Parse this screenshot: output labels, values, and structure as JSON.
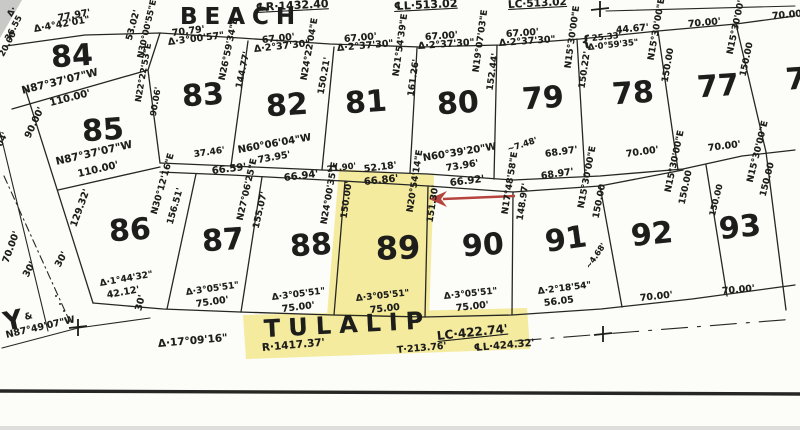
{
  "document": {
    "type": "scanned plat map",
    "streets": {
      "top": "BEACH",
      "bottom": "TULALIP",
      "left": "Y"
    },
    "highlighted_lot": "89",
    "lot_numbers_visible": [
      "77",
      "78",
      "79",
      "80",
      "81",
      "82",
      "83",
      "84",
      "85",
      "86",
      "87",
      "88",
      "89",
      "90",
      "91",
      "92",
      "93"
    ],
    "beach_curve_annotations": [
      "℄R·1432.40",
      "℄L·513.02",
      "LC·513.02"
    ],
    "tulalip_curve_annotations": [
      "Δ·17°09'16\"",
      "R·1417.37'",
      "T·213.76'",
      "℄L·424.32'",
      "LC·422.74'"
    ]
  },
  "colors": {
    "ink": "#262624",
    "highlight": "#f3e996",
    "arrow": "#b5443e",
    "paper": "#fcfcf8"
  },
  "labels": [
    {
      "t": "℄R·1432.40",
      "x": 256,
      "y": 2,
      "r": -3,
      "fs": 11,
      "u": 1
    },
    {
      "t": "℄L·513.02",
      "x": 394,
      "y": 1,
      "r": -3,
      "fs": 11,
      "u": 1
    },
    {
      "t": "LC·513.02",
      "x": 508,
      "y": 0,
      "r": -3,
      "fs": 10.5,
      "u": 1
    },
    {
      "t": "BEACH",
      "x": 180,
      "y": 6,
      "fs": 23,
      "w": 700,
      "ls": 7,
      "n": "street-name-beach"
    },
    {
      "t": "77.97'",
      "x": 58,
      "y": 14,
      "r": -10
    },
    {
      "t": "Δ·4°42'01\"",
      "x": 34,
      "y": 25,
      "r": -10
    },
    {
      "t": "70.79'",
      "x": 172,
      "y": 29,
      "r": -7
    },
    {
      "t": "Δ·3°00'57\"",
      "x": 168,
      "y": 38,
      "r": -7
    },
    {
      "t": "67.00'",
      "x": 262,
      "y": 36,
      "r": -6
    },
    {
      "t": "Δ·2°37'30\"",
      "x": 254,
      "y": 45,
      "r": -6
    },
    {
      "t": "67.00'",
      "x": 344,
      "y": 35,
      "r": -5
    },
    {
      "t": "Δ·2°37'30\"",
      "x": 337,
      "y": 44,
      "r": -5
    },
    {
      "t": "67.00'",
      "x": 425,
      "y": 33,
      "r": -4
    },
    {
      "t": "Δ·2°37'30\"",
      "x": 418,
      "y": 42,
      "r": -4
    },
    {
      "t": "67.00'",
      "x": 506,
      "y": 30,
      "r": -4
    },
    {
      "t": "Δ·2°37'30\"",
      "x": 499,
      "y": 39,
      "r": -4
    },
    {
      "t": "44.67'",
      "x": 616,
      "y": 26,
      "r": -5
    },
    {
      "t": "{",
      "x": 581,
      "y": 35,
      "r": -8,
      "fs": 15
    },
    {
      "t": "25.33'",
      "x": 592,
      "y": 35,
      "r": -6,
      "fs": 8.5
    },
    {
      "t": "Δ·0°59'35\"",
      "x": 588,
      "y": 44,
      "r": -6,
      "fs": 8.5
    },
    {
      "t": "70.00'",
      "x": 688,
      "y": 20,
      "r": -5
    },
    {
      "t": "70.00'",
      "x": 772,
      "y": 12,
      "r": -5
    },
    {
      "t": "Δ·",
      "x": 10,
      "y": 12,
      "r": -60,
      "fs": 8.5
    },
    {
      "t": "36.55",
      "x": 8,
      "y": 36,
      "r": -62,
      "fs": 8.5
    },
    {
      "t": "20.00",
      "x": 2,
      "y": 52,
      "r": -62,
      "fs": 8.5
    },
    {
      "t": "04'",
      "x": 0,
      "y": 142,
      "r": -65,
      "fs": 8.5
    },
    {
      "t": "N87°37'07\"W",
      "x": 22,
      "y": 86,
      "r": -14,
      "fs": 10.5
    },
    {
      "t": "110.00'",
      "x": 50,
      "y": 99,
      "r": -14,
      "fs": 10
    },
    {
      "t": "90.00'",
      "x": 28,
      "y": 133,
      "r": -65
    },
    {
      "t": "53.02'",
      "x": 130,
      "y": 36,
      "r": -75,
      "fs": 9
    },
    {
      "t": "N30°00'55\"E",
      "x": 141,
      "y": 54,
      "r": -77,
      "fs": 8.5
    },
    {
      "t": "N22°22'53\"E",
      "x": 139,
      "y": 98,
      "r": -80,
      "fs": 8.5
    },
    {
      "t": "90.06'",
      "x": 154,
      "y": 112,
      "r": -80,
      "fs": 8.5
    },
    {
      "t": "N87°37'07\"W",
      "x": 56,
      "y": 157,
      "r": -13,
      "fs": 10.5
    },
    {
      "t": "110.00'",
      "x": 78,
      "y": 170,
      "r": -13,
      "fs": 10
    },
    {
      "t": "N26°59'34\"E",
      "x": 223,
      "y": 76,
      "r": -78,
      "fs": 9
    },
    {
      "t": "144.77'",
      "x": 240,
      "y": 84,
      "r": -78,
      "fs": 9
    },
    {
      "t": "37.46'",
      "x": 194,
      "y": 151,
      "r": -8,
      "fs": 9
    },
    {
      "t": "66.59'",
      "x": 212,
      "y": 167,
      "r": -7,
      "fs": 10
    },
    {
      "t": "N24°22'04\"E",
      "x": 305,
      "y": 76,
      "r": -80,
      "fs": 9
    },
    {
      "t": "150.21'",
      "x": 322,
      "y": 90,
      "r": -80,
      "fs": 9
    },
    {
      "t": "N60°06'04\"W",
      "x": 238,
      "y": 146,
      "r": -10,
      "fs": 10
    },
    {
      "t": "73.95'",
      "x": 258,
      "y": 156,
      "r": -10
    },
    {
      "t": "66.94'",
      "x": 284,
      "y": 174,
      "r": -7,
      "fs": 10
    },
    {
      "t": "N21°54'39\"E",
      "x": 397,
      "y": 72,
      "r": -82,
      "fs": 9
    },
    {
      "t": "161.26'",
      "x": 412,
      "y": 92,
      "r": -82,
      "fs": 9
    },
    {
      "t": "21.90'",
      "x": 327,
      "y": 166,
      "r": -7,
      "fs": 8.5
    },
    {
      "t": "52.18'",
      "x": 364,
      "y": 165,
      "r": -7
    },
    {
      "t": "N19°07'03\"E",
      "x": 477,
      "y": 68,
      "r": -82,
      "fs": 9
    },
    {
      "t": "152.44'",
      "x": 491,
      "y": 86,
      "r": -82,
      "fs": 9
    },
    {
      "t": "N60°39'20\"W",
      "x": 423,
      "y": 154,
      "r": -9,
      "fs": 10
    },
    {
      "t": "73.96'",
      "x": 446,
      "y": 164,
      "r": -9
    },
    {
      "t": "66.92'",
      "x": 450,
      "y": 179,
      "r": -7,
      "fs": 10
    },
    {
      "t": "N15°30'00\"E",
      "x": 569,
      "y": 64,
      "r": -82,
      "fs": 9
    },
    {
      "t": "150.22'",
      "x": 583,
      "y": 84,
      "r": -82,
      "fs": 9
    },
    {
      "t": "~7.48'",
      "x": 508,
      "y": 146,
      "r": -18,
      "fs": 8.5
    },
    {
      "t": "68.97'",
      "x": 545,
      "y": 150,
      "r": -8
    },
    {
      "t": "68.97'",
      "x": 541,
      "y": 172,
      "r": -8
    },
    {
      "t": "N15°30'00\"E",
      "x": 652,
      "y": 56,
      "r": -80,
      "fs": 9
    },
    {
      "t": "150.00",
      "x": 666,
      "y": 78,
      "r": -80,
      "fs": 9
    },
    {
      "t": "70.00'",
      "x": 626,
      "y": 150,
      "r": -8
    },
    {
      "t": "N15°30'00\"E",
      "x": 731,
      "y": 50,
      "r": -78,
      "fs": 9
    },
    {
      "t": "150.00",
      "x": 744,
      "y": 72,
      "r": -78,
      "fs": 9
    },
    {
      "t": "70.00'",
      "x": 708,
      "y": 144,
      "r": -7
    },
    {
      "t": "N30°12'16\"E",
      "x": 155,
      "y": 210,
      "r": -74,
      "fs": 9
    },
    {
      "t": "156.51'",
      "x": 171,
      "y": 220,
      "r": -74,
      "fs": 9
    },
    {
      "t": "Δ·1°44'32\"",
      "x": 100,
      "y": 280,
      "r": -10,
      "fs": 9
    },
    {
      "t": "42.12'",
      "x": 107,
      "y": 291,
      "r": -10
    },
    {
      "t": "N27°06'25\"E",
      "x": 241,
      "y": 216,
      "r": -77,
      "fs": 9
    },
    {
      "t": "155.07'",
      "x": 257,
      "y": 224,
      "r": -77,
      "fs": 9
    },
    {
      "t": "Δ·3°05'51\"",
      "x": 186,
      "y": 289,
      "r": -8,
      "fs": 9
    },
    {
      "t": "75.00'",
      "x": 196,
      "y": 300,
      "r": -8
    },
    {
      "t": "N24°00'35\"E",
      "x": 325,
      "y": 220,
      "r": -80,
      "fs": 9
    },
    {
      "t": "Δ·3°05'51\"",
      "x": 272,
      "y": 294,
      "r": -7,
      "fs": 9
    },
    {
      "t": "75.00'",
      "x": 282,
      "y": 305,
      "r": -7
    },
    {
      "t": "66.86'",
      "x": 364,
      "y": 178,
      "r": -6,
      "fs": 10
    },
    {
      "t": "150.00'",
      "x": 345,
      "y": 214,
      "r": -82,
      "fs": 9
    },
    {
      "t": "N20°54'14\"E",
      "x": 411,
      "y": 208,
      "r": -81,
      "fs": 9
    },
    {
      "t": "151.30'",
      "x": 431,
      "y": 218,
      "r": -81,
      "fs": 9
    },
    {
      "t": "Δ·3°05'51\"",
      "x": 356,
      "y": 295,
      "r": -6,
      "fs": 9
    },
    {
      "t": "75.00",
      "x": 370,
      "y": 306,
      "r": -6
    },
    {
      "t": "N17°48'58\"E",
      "x": 506,
      "y": 210,
      "r": -81,
      "fs": 9
    },
    {
      "t": "148.97'",
      "x": 521,
      "y": 216,
      "r": -81,
      "fs": 9
    },
    {
      "t": "Δ·3°05'51\"",
      "x": 444,
      "y": 293,
      "r": -6,
      "fs": 9
    },
    {
      "t": "75.00'",
      "x": 456,
      "y": 304,
      "r": -6
    },
    {
      "t": "N15°30'00\"E",
      "x": 582,
      "y": 204,
      "r": -79,
      "fs": 9
    },
    {
      "t": "150.00",
      "x": 597,
      "y": 214,
      "r": -79,
      "fs": 9
    },
    {
      "t": "~4.68'",
      "x": 588,
      "y": 264,
      "r": -55,
      "fs": 8
    },
    {
      "t": "Δ·2°18'54\"",
      "x": 538,
      "y": 288,
      "r": -7,
      "fs": 9
    },
    {
      "t": "56.05",
      "x": 544,
      "y": 299,
      "r": -7
    },
    {
      "t": "N15°30'00\"E",
      "x": 669,
      "y": 188,
      "r": -78,
      "fs": 9
    },
    {
      "t": "150.00",
      "x": 683,
      "y": 200,
      "r": -78,
      "fs": 9
    },
    {
      "t": "70.00'",
      "x": 640,
      "y": 294,
      "r": -6
    },
    {
      "t": "150.00",
      "x": 713,
      "y": 212,
      "r": -76,
      "fs": 8.5
    },
    {
      "t": "N15°30'00\"E",
      "x": 751,
      "y": 178,
      "r": -76,
      "fs": 9
    },
    {
      "t": "150.00",
      "x": 764,
      "y": 192,
      "r": -76,
      "fs": 9
    },
    {
      "t": "70.00'",
      "x": 722,
      "y": 287,
      "r": -5
    },
    {
      "t": "Y",
      "x": 4,
      "y": 310,
      "fs": 26,
      "w": 700,
      "r": -12,
      "n": "street-name-y"
    },
    {
      "t": "&",
      "x": 25,
      "y": 314,
      "r": -15,
      "fs": 9
    },
    {
      "t": "N87°49'07\"W",
      "x": 6,
      "y": 331,
      "r": -13
    },
    {
      "t": "30'",
      "x": 26,
      "y": 272,
      "r": -62
    },
    {
      "t": "30'",
      "x": 58,
      "y": 262,
      "r": -62
    },
    {
      "t": "30'",
      "x": 139,
      "y": 306,
      "r": -76
    },
    {
      "t": "70.00'",
      "x": 6,
      "y": 258,
      "r": -70
    },
    {
      "t": "129.32'",
      "x": 74,
      "y": 222,
      "r": -70
    },
    {
      "t": "TULALIP",
      "x": 264,
      "y": 317,
      "fs": 24,
      "w": 700,
      "ls": 8,
      "r": -3,
      "n": "street-name-tulalip"
    },
    {
      "t": "Δ·17°09'16\"",
      "x": 158,
      "y": 339,
      "r": -5,
      "fs": 10.5
    },
    {
      "t": "R·1417.37'",
      "x": 262,
      "y": 343,
      "r": -5,
      "fs": 10.5
    },
    {
      "t": "T·213.76'",
      "x": 397,
      "y": 346,
      "r": -5,
      "fs": 9.5
    },
    {
      "t": "℄L·424.32'",
      "x": 474,
      "y": 344,
      "r": -5,
      "fs": 10
    },
    {
      "t": "LC·422.74'",
      "x": 437,
      "y": 330,
      "r": -6,
      "fs": 12,
      "u": 1
    },
    {
      "t": "84",
      "x": 72,
      "y": 57,
      "c": 1,
      "r": -4,
      "fs": 30,
      "w": 700,
      "n": "lot-number-84"
    },
    {
      "t": "85",
      "x": 103,
      "y": 131,
      "c": 1,
      "r": -4,
      "fs": 30,
      "w": 700,
      "n": "lot-number-85"
    },
    {
      "t": "83",
      "x": 203,
      "y": 96,
      "c": 1,
      "r": -4,
      "fs": 30,
      "w": 700,
      "n": "lot-number-83"
    },
    {
      "t": "82",
      "x": 287,
      "y": 106,
      "c": 1,
      "r": -4,
      "fs": 30,
      "w": 700,
      "n": "lot-number-82"
    },
    {
      "t": "81",
      "x": 366,
      "y": 103,
      "c": 1,
      "r": -4,
      "fs": 30,
      "w": 700,
      "n": "lot-number-81"
    },
    {
      "t": "80",
      "x": 458,
      "y": 104,
      "c": 1,
      "r": -4,
      "fs": 30,
      "w": 700,
      "n": "lot-number-80"
    },
    {
      "t": "79",
      "x": 543,
      "y": 99,
      "c": 1,
      "r": -4,
      "fs": 30,
      "w": 700,
      "n": "lot-number-79"
    },
    {
      "t": "78",
      "x": 633,
      "y": 94,
      "c": 1,
      "r": -4,
      "fs": 30,
      "w": 700,
      "n": "lot-number-78"
    },
    {
      "t": "77",
      "x": 718,
      "y": 87,
      "c": 1,
      "r": -4,
      "fs": 30,
      "w": 700,
      "n": "lot-number-77"
    },
    {
      "t": "7",
      "x": 796,
      "y": 80,
      "c": 1,
      "r": -4,
      "fs": 30,
      "w": 700,
      "n": "lot-number-76-partial"
    },
    {
      "t": "86",
      "x": 130,
      "y": 231,
      "c": 1,
      "r": -4,
      "fs": 30,
      "w": 700,
      "n": "lot-number-86"
    },
    {
      "t": "87",
      "x": 223,
      "y": 241,
      "c": 1,
      "r": -4,
      "fs": 30,
      "w": 700,
      "n": "lot-number-87"
    },
    {
      "t": "88",
      "x": 311,
      "y": 246,
      "c": 1,
      "r": -4,
      "fs": 30,
      "w": 700,
      "n": "lot-number-88"
    },
    {
      "t": "89",
      "x": 398,
      "y": 248,
      "c": 1,
      "r": -2,
      "fs": 32,
      "w": 700,
      "n": "lot-number-89"
    },
    {
      "t": "90",
      "x": 483,
      "y": 246,
      "c": 1,
      "r": -4,
      "fs": 30,
      "w": 700,
      "n": "lot-number-90"
    },
    {
      "t": "91",
      "x": 566,
      "y": 240,
      "c": 1,
      "r": -8,
      "fs": 30,
      "w": 700,
      "n": "lot-number-91"
    },
    {
      "t": "92",
      "x": 652,
      "y": 235,
      "c": 1,
      "r": -6,
      "fs": 30,
      "w": 700,
      "n": "lot-number-92"
    },
    {
      "t": "93",
      "x": 740,
      "y": 228,
      "c": 1,
      "r": -6,
      "fs": 30,
      "w": 700,
      "n": "lot-number-93"
    }
  ]
}
